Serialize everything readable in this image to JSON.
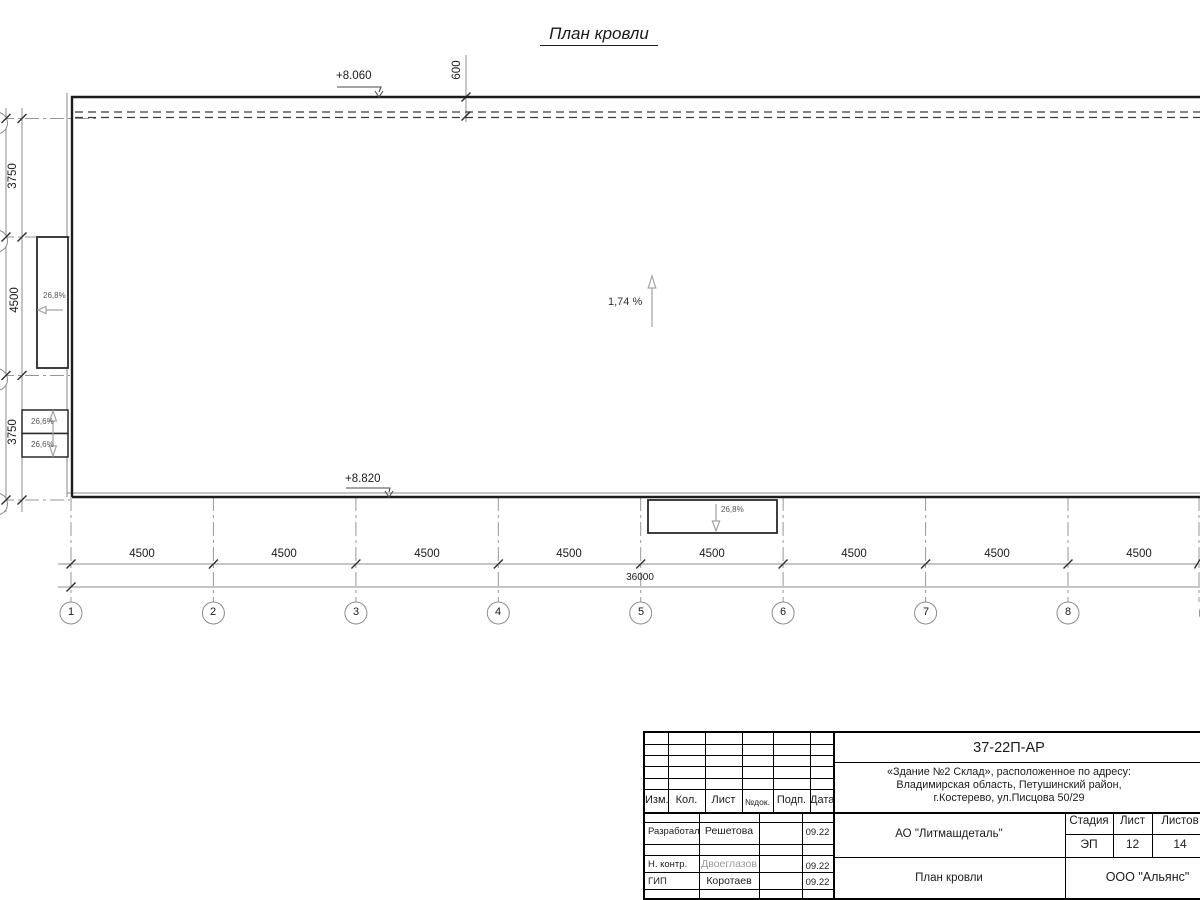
{
  "title": "План кровли",
  "drawing": {
    "elevation_top": "+8.060",
    "elevation_bottom": "+8.820",
    "parapet_offset": "600",
    "slope_main": "1,74 %",
    "slope_left_canopy": "26,8%",
    "slope_bottom_canopy": "26,8%",
    "slope_small_top": "26,6%",
    "slope_small_bottom": "26,6%"
  },
  "dims": {
    "bays": [
      "4500",
      "4500",
      "4500",
      "4500",
      "4500",
      "4500",
      "4500",
      "4500"
    ],
    "total": "36000",
    "left": [
      "3750",
      "4500",
      "3750"
    ],
    "left_total": "12000"
  },
  "axes": {
    "columns": [
      "1",
      "2",
      "3",
      "4",
      "5",
      "6",
      "7",
      "8"
    ]
  },
  "titleblock": {
    "doc_number": "37-22П-АР",
    "address_line1": "«Здание №2 Склад», расположенное по адресу:",
    "address_line2": "Владимирская область, Петушинский район,",
    "address_line3": "г.Костерево, ул.Писцова 50/29",
    "header": {
      "izm": "Изм.",
      "kol": "Кол.",
      "list": "Лист",
      "ndok": "№док.",
      "podp": "Подп.",
      "data": "Дата"
    },
    "rows": [
      {
        "role": "Разработал",
        "name": "Решетова",
        "date": "09.22"
      },
      {
        "role": "Н. контр.",
        "name": "Двоеглазов",
        "date": "09.22"
      },
      {
        "role": "ГИП",
        "name": "Коротаев",
        "date": "09.22"
      }
    ],
    "customer": "АО \"Литмашдеталь\"",
    "stage_label": "Стадия",
    "sheet_label": "Лист",
    "sheets_label": "Листов",
    "stage": "ЭП",
    "sheet": "12",
    "sheets": "14",
    "sheet_title": "План кровли",
    "org": "ООО \"Альянс\""
  }
}
